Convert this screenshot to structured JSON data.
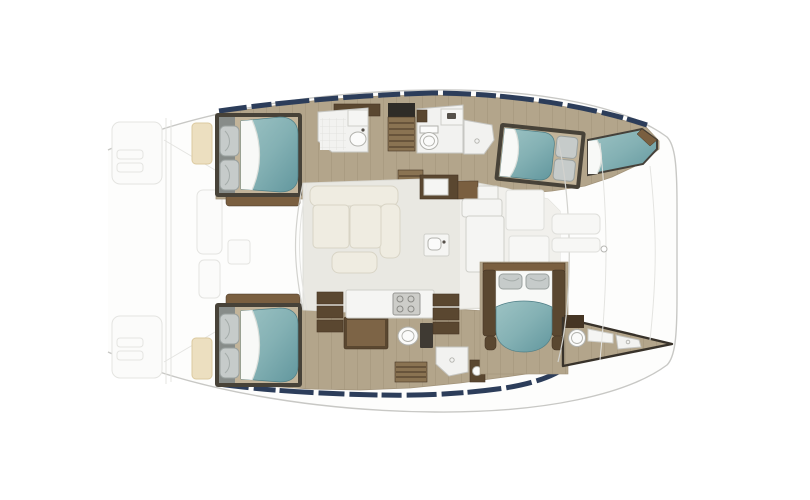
{
  "scene": {
    "diagram_type": "catamaran-interior-floor-plan",
    "view": "top-down",
    "orientation": "bow-left-stern-right"
  },
  "colors": {
    "outline": "#c8c8c5",
    "faint": "#e4e4e1",
    "deck": "#fdfdfc",
    "wood": "#b3a58b",
    "wood_line": "#a2937a",
    "wood_light": "#c2b49a",
    "wood_mid": "#8a7352",
    "shelf_brown": "#7a5f40",
    "cabinet_brown": "#5a4730",
    "cabinet_dark": "#453524",
    "frame_dark": "#474238",
    "hatch_dark": "#2f2c27",
    "window_navy": "#2c3d5a",
    "bed_teal_light": "#9dc3c4",
    "bed_teal": "#84b1b4",
    "bed_teal_dark": "#62979e",
    "sheet": "#f8f9f7",
    "pillow": "#c6cbca",
    "pillow_edge": "#9aa19f",
    "bath": "#f2f2f0",
    "fixture": "#fbfbfa",
    "fixture_edge": "#b2b2ad",
    "saloon_floor": "#e9e8e2",
    "galley_floor": "#f1f0ec",
    "sofa": "#efece1",
    "sofa_edge": "#d8d4c5",
    "counter": "#f5f5f3",
    "counter_edge": "#cfcfca",
    "stove": "#cdcdc9",
    "pad_beige": "#ecdfc0",
    "wedge_dark": "#38322a"
  },
  "areas": [
    {
      "name": "foredeck",
      "features": [
        "trampoline",
        "sun-pads",
        "bow-seats",
        "crossbeam"
      ]
    },
    {
      "name": "forward-cabin-starboard",
      "features": [
        "double-berth-teal",
        "two-pillows",
        "headboard-lockers"
      ]
    },
    {
      "name": "forward-head-starboard",
      "features": [
        "shower-tile",
        "round-sink",
        "vanity-cabinet"
      ]
    },
    {
      "name": "companionway-starboard",
      "features": [
        "stairs-down"
      ]
    },
    {
      "name": "aft-head-starboard",
      "features": [
        "toilet",
        "counter",
        "separate-shower"
      ]
    },
    {
      "name": "aft-cabin-starboard",
      "features": [
        "double-berth-teal",
        "two-pillows"
      ]
    },
    {
      "name": "stern-berth-starboard",
      "features": [
        "berth-cushion-wedge"
      ]
    },
    {
      "name": "saloon",
      "features": [
        "u-shaped-sofa",
        "coffee-table",
        "windshield"
      ]
    },
    {
      "name": "galley",
      "features": [
        "sink",
        "stove-island",
        "counters",
        "drawer-stacks",
        "lockers"
      ]
    },
    {
      "name": "forward-cabin-port",
      "features": [
        "double-berth-teal",
        "two-pillows",
        "headboard-lockers"
      ]
    },
    {
      "name": "port-hull-amidships",
      "features": [
        "desk",
        "toilet",
        "shower",
        "washbasin",
        "stairs-down"
      ]
    },
    {
      "name": "owner-cabin",
      "features": [
        "double-berth-teal",
        "two-pillows",
        "bed-frame-rails"
      ]
    },
    {
      "name": "owner-bathroom-stern-wedge",
      "features": [
        "round-sink",
        "vanity",
        "counter",
        "shower-pan"
      ]
    },
    {
      "name": "cockpit",
      "features": [
        "sliding-door-wall",
        "door-handle",
        "benches",
        "transom"
      ]
    }
  ]
}
